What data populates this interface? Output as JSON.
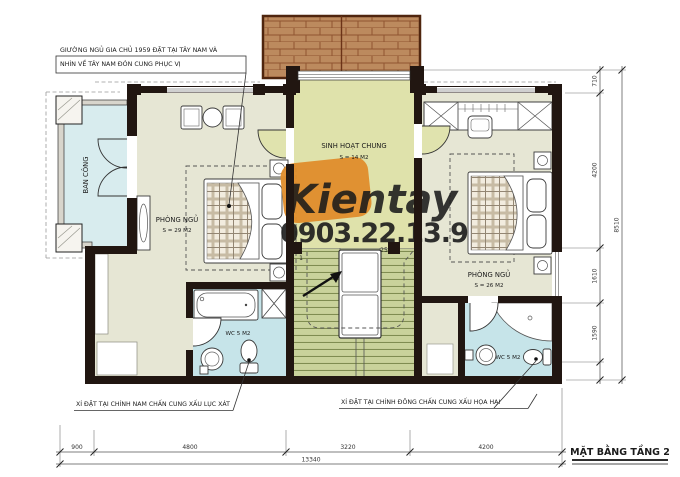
{
  "title": "MẶT BẰNG TẦNG 2",
  "watermark": {
    "brand": "Kientay",
    "phone": "0903.22.13.9",
    "orange": "#df8c2b",
    "gray": "#8a8a7d"
  },
  "notes": {
    "master_bed_line1": "GIƯỜNG NGỦ GIA CHỦ 1959 ĐẶT TẠI TÂY NAM VÀ",
    "master_bed_line2": "NHÌN VỀ TÂY NAM ĐÓN CUNG PHỤC VỊ",
    "wc_left": "XÍ ĐẶT TẠI CHÍNH NAM CHẤN CUNG XẤU LỤC XÁT",
    "wc_right": "XÍ ĐẶT TẠI CHÍNH ĐÔNG CHẤN CUNG XẤU HỌA HẠI"
  },
  "rooms": {
    "balcony": "BAN CÔNG",
    "bedroom_left_name": "PHÒNG NGỦ",
    "bedroom_left_area": "S = 29 M2",
    "living_name": "SINH HOẠT CHUNG",
    "living_area": "S = 14 M2",
    "bedroom_right_name": "PHÒNG NGỦ",
    "bedroom_right_area": "S = 26 M2",
    "wc_left": "WC 5 M2",
    "wc_right": "WC 5 M2"
  },
  "stairs": {
    "first_step": "1",
    "last_step": "25"
  },
  "dimensions": {
    "bottom": [
      "900",
      "4800",
      "3220",
      "4200"
    ],
    "bottom_total": "13340",
    "right": [
      "710",
      "4200",
      "1610",
      "1590"
    ],
    "right_total": "8510"
  },
  "colors": {
    "floor_bedroom": "#e6e6d4",
    "floor_living": "#dfe2ab",
    "floor_stairs": "#c9d29b",
    "floor_wc": "#c6e4e9",
    "floor_balcony": "#d8ecee",
    "wall": "#211611",
    "roof": "#bc8a5e"
  }
}
